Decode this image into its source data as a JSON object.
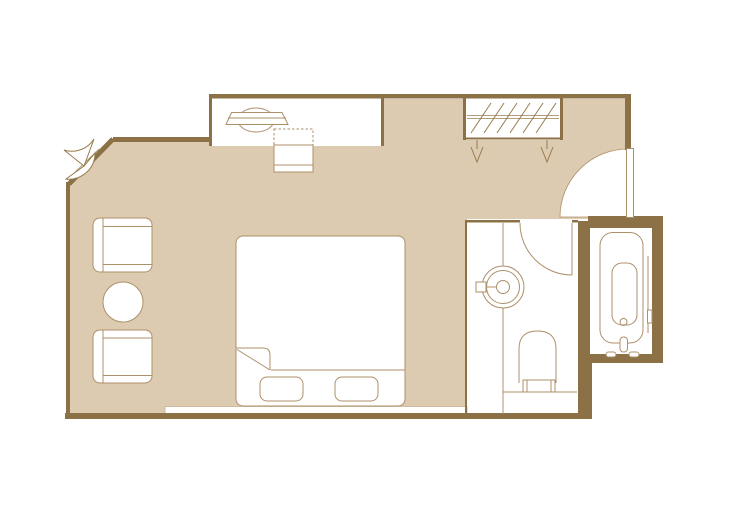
{
  "document_title": "Hotel Guestroom Floor Plan",
  "plan": {
    "type": "floor-plan",
    "rooms": [
      {
        "id": "bedroom",
        "label": "Bedroom"
      },
      {
        "id": "desk-alcove",
        "label": "Desk alcove"
      },
      {
        "id": "wardrobe",
        "label": "Wardrobe closet"
      },
      {
        "id": "entry",
        "label": "Entry door"
      },
      {
        "id": "bathroom",
        "label": "Bathroom"
      },
      {
        "id": "bathtub-room",
        "label": "Bathtub room"
      }
    ],
    "furniture": {
      "bed": {
        "label": "King bed with turned-down sheet"
      },
      "pillow_left": {
        "label": "Pillow (left)"
      },
      "pillow_right": {
        "label": "Pillow (right)"
      },
      "headboard": {
        "label": "Headboard bench"
      },
      "armchair_top": {
        "label": "Armchair (upper)"
      },
      "armchair_bottom": {
        "label": "Armchair (lower)"
      },
      "side_table": {
        "label": "Round side table"
      },
      "desk_chair": {
        "label": "Desk chair"
      },
      "luggage_rack": {
        "label": "Desk / luggage rack"
      },
      "hanging_rail": {
        "label": "Wardrobe hanging rail with clothes"
      },
      "hangers": {
        "label": "Clothes hangers"
      },
      "corner_window": {
        "label": "Corner casement window"
      },
      "entry_door": {
        "label": "Entry door swing"
      },
      "bathroom_door": {
        "label": "Bathroom door swing"
      },
      "washbasin": {
        "label": "Round vessel washbasin with faucet"
      },
      "vanity": {
        "label": "Vanity counter"
      },
      "toilet": {
        "label": "Toilet"
      },
      "bathtub": {
        "label": "Bathtub with faucet and handles"
      }
    }
  },
  "colors": {
    "page-background": "#ffffff",
    "wall": "#8c7146",
    "floor": "#dccbb0",
    "room-fill": "#ffffff",
    "furniture-line": "#ac9069",
    "furniture-line-dark": "#997c50",
    "strip-edge": "#c9b393"
  }
}
